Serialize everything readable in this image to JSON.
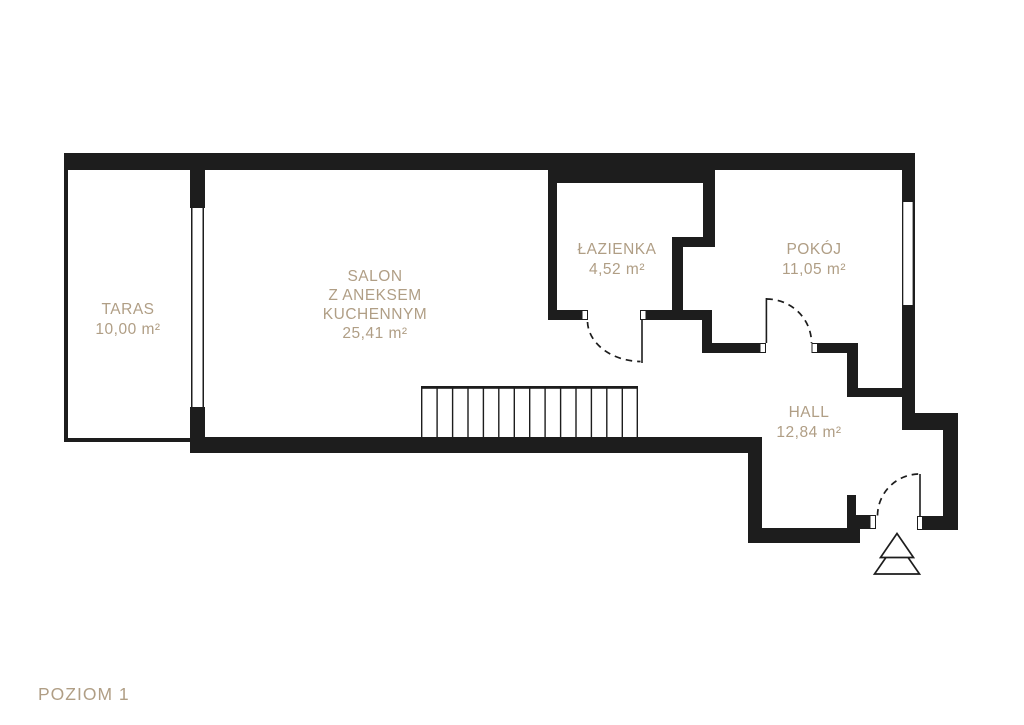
{
  "title": "POZIOM 1",
  "colors": {
    "wall": "#1d1d1d",
    "label": "#b09e85",
    "bg": "#ffffff"
  },
  "rooms": {
    "taras": {
      "name": "TARAS",
      "area": "10,00 m²"
    },
    "salon": {
      "name_line1": "SALON",
      "name_line2": "Z ANEKSEM",
      "name_line3": "KUCHENNYM",
      "area": "25,41 m²"
    },
    "lazienka": {
      "name": "ŁAZIENKA",
      "area": "4,52 m²"
    },
    "pokoj": {
      "name": "POKÓJ",
      "area": "11,05 m²"
    },
    "hall": {
      "name": "HALL",
      "area": "12,84 m²"
    }
  },
  "symbols": {
    "entrance_arrow": "entrance-direction-arrow",
    "staircase": "staircase-14-treads",
    "doors": [
      "bathroom-door-swing",
      "room-door-swing",
      "entry-door-swing"
    ],
    "windows": [
      "terrace-window",
      "room-window"
    ]
  }
}
